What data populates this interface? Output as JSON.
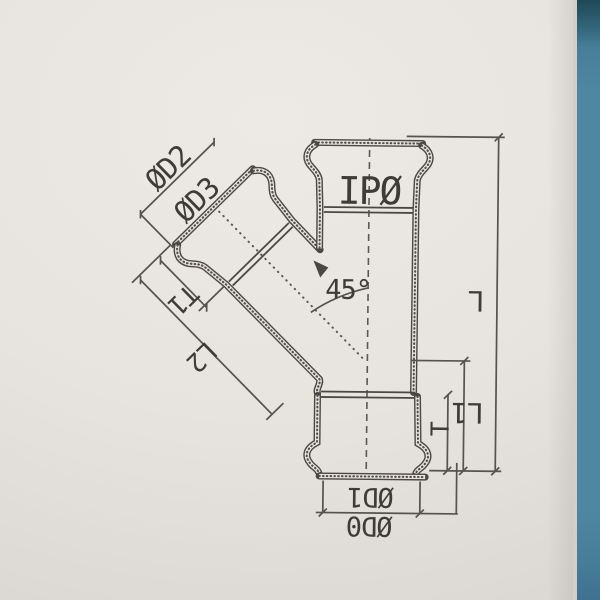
{
  "figure": {
    "type": "technical-drawing",
    "subject": "45-degree wye branch pipe fitting, sectional view with sockets",
    "labels": {
      "d2": "ØD2",
      "d3": "ØD3",
      "ipo": "IPØ",
      "angle": "45°",
      "t1": "T1",
      "l2": "L2",
      "L": "L",
      "l1": "L1",
      "t": "T",
      "d1": "ØD1",
      "d0": "ØD0"
    },
    "angle_value_deg": 45,
    "colors": {
      "paper": "#e7e3de",
      "line": "#4b4744",
      "text": "#3f3c38",
      "strip": "#4e87a2",
      "strip_dark": "#1f4856"
    }
  }
}
